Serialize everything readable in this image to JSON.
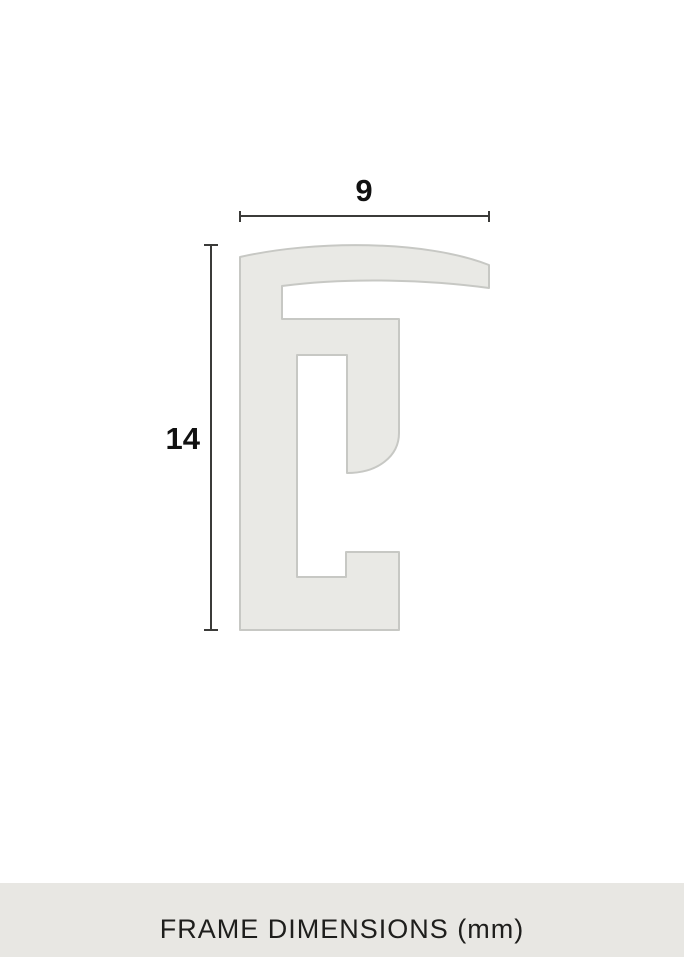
{
  "diagram": {
    "title": "frame profile cross-section",
    "width_label": "9",
    "height_label": "14",
    "width_mm": 9,
    "height_mm": 14,
    "units": "mm",
    "caption": "FRAME DIMENSIONS (mm)"
  },
  "colors": {
    "background": "#ffffff",
    "profile_fill": "#e9e9e5",
    "profile_outline": "#c7c8c4",
    "dimension_line": "#3b3b39",
    "label_text": "#111111",
    "caption_bar_bg": "#e8e7e3",
    "caption_text": "#1e1e1c"
  }
}
